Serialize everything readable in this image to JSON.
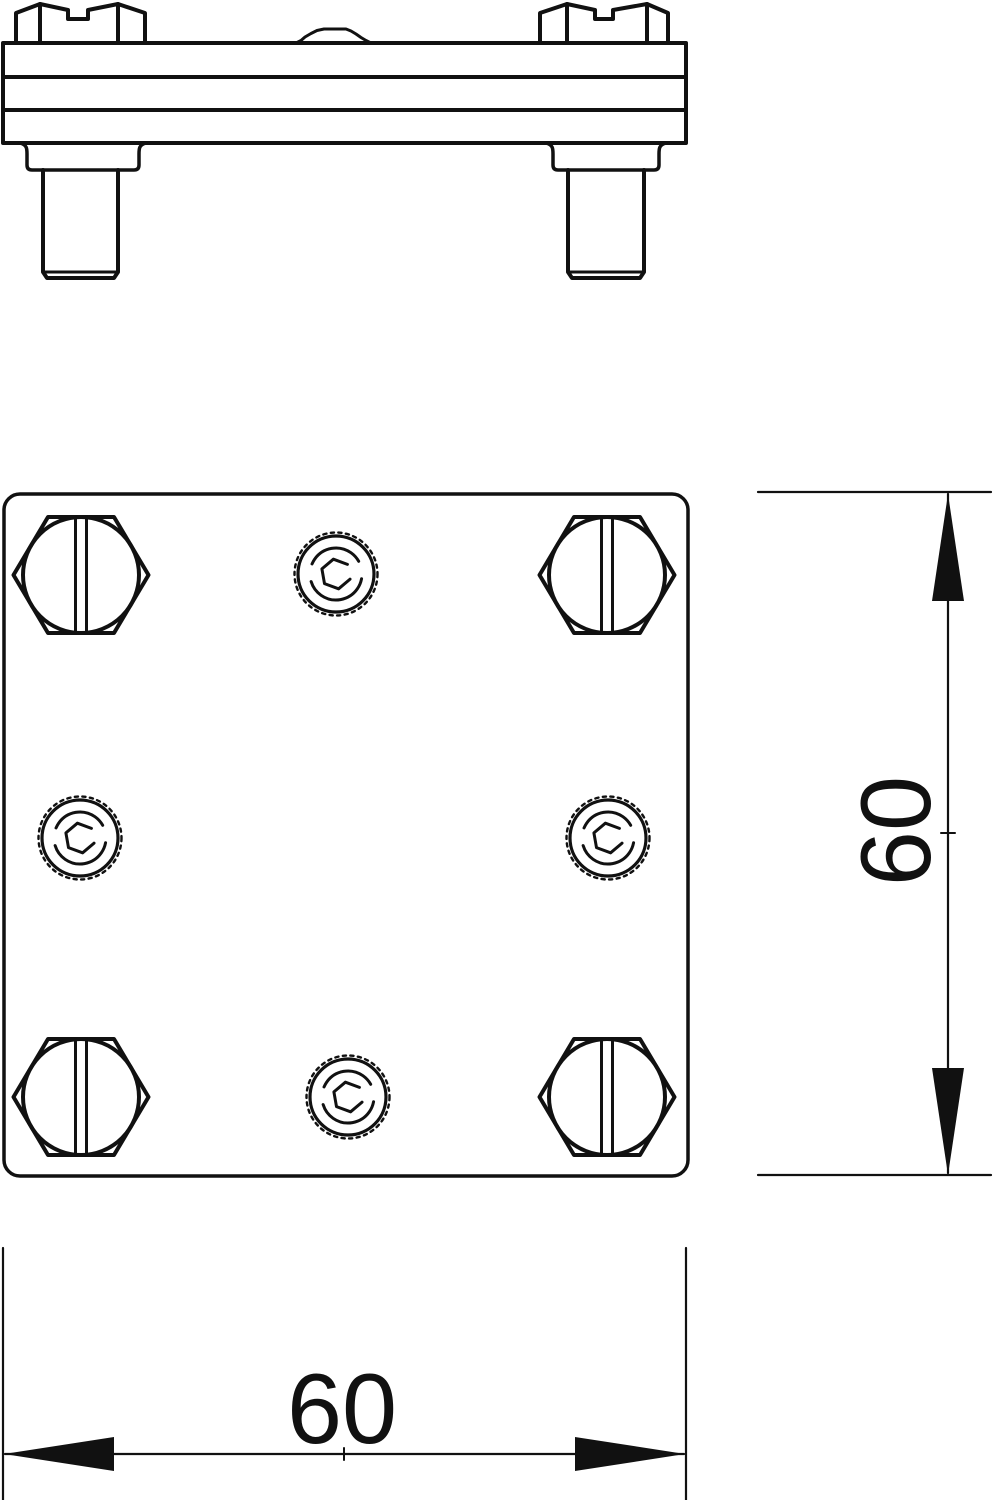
{
  "dimensions": {
    "width_value": "60",
    "height_value": "60"
  },
  "style": {
    "line_color": "#111111",
    "background_color": "#ffffff"
  }
}
